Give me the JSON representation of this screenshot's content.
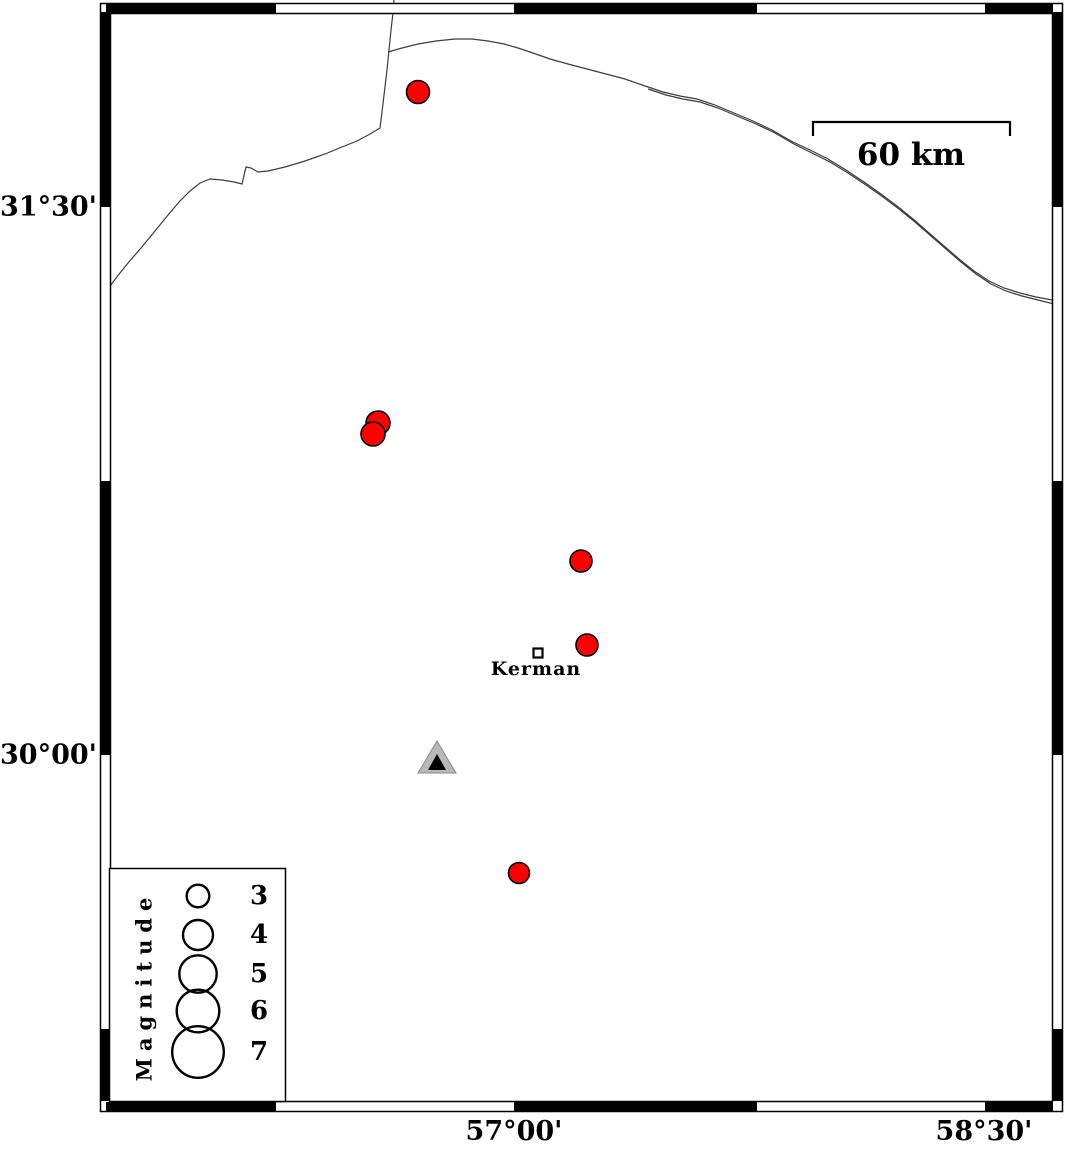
{
  "colors": {
    "epicenter_fill": "#ff0000",
    "epicenter_stroke": "#000000",
    "station_fill": "#b8b8b8",
    "station_edge": "#8a8a8a",
    "station_inner": "#000000",
    "fault_line": "#3d3d3d",
    "frame": "#000000",
    "background": "#ffffff"
  },
  "frame": {
    "outer": {
      "x": 100.5,
      "y": 3.5,
      "w": 962,
      "h": 1108
    },
    "inner": {
      "x": 110.5,
      "y": 13.5,
      "w": 942,
      "h": 1088
    },
    "band_h_black_segments": [
      [
        106,
        276
      ],
      [
        514,
        757
      ],
      [
        985,
        1053
      ]
    ],
    "band_v_black_segments": [
      [
        12,
        207
      ],
      [
        481,
        755
      ],
      [
        1029,
        1101
      ]
    ]
  },
  "axes": {
    "left": [
      {
        "label": "31°30'",
        "y": 207
      },
      {
        "label": "30°00'",
        "y": 755
      }
    ],
    "bottom": [
      {
        "label": "57°00'",
        "x": 514
      },
      {
        "label": "58°30'",
        "x": 984
      }
    ]
  },
  "scale_bar": {
    "label": "60 km",
    "x1": 813,
    "x2": 1010,
    "y": 122,
    "tick_len": 14,
    "label_cx": 911,
    "label_cy": 155
  },
  "city": {
    "name": "Kerman",
    "square": {
      "x": 533.5,
      "y": 648.5,
      "size": 9
    },
    "label_cx": 536,
    "label_cy": 669
  },
  "station": {
    "outer": {
      "apex_x": 437,
      "apex_y": 741,
      "base_y": 773,
      "half_w": 19
    },
    "inner": {
      "apex_x": 437,
      "apex_y": 754,
      "base_y": 770,
      "half_w": 9
    }
  },
  "earthquakes": [
    {
      "x": 418,
      "y": 92,
      "r": 11.5
    },
    {
      "x": 378,
      "y": 423,
      "r": 12
    },
    {
      "x": 373,
      "y": 434,
      "r": 12
    },
    {
      "x": 581,
      "y": 561,
      "r": 11
    },
    {
      "x": 587,
      "y": 645,
      "r": 11
    },
    {
      "x": 519,
      "y": 873,
      "r": 10.5
    }
  ],
  "legend": {
    "title": "Magnitude",
    "box": {
      "x": 109.5,
      "y": 868.5,
      "w": 176,
      "h": 233
    },
    "title_cx": 144,
    "title_cy": 986,
    "circle_cx": 198,
    "num_cx": 259,
    "entries": [
      {
        "magnitude": "3",
        "cy": 896,
        "r": 11.3
      },
      {
        "magnitude": "4",
        "cy": 935,
        "r": 15
      },
      {
        "magnitude": "5",
        "cy": 974,
        "r": 18.7
      },
      {
        "magnitude": "6",
        "cy": 1011,
        "r": 21.3
      },
      {
        "magnitude": "7",
        "cy": 1052,
        "r": 25.8
      }
    ]
  },
  "fault_lines": [
    {
      "name": "boundary-line-west",
      "d": "M394,0 L393,13 L391,30 L389,50 L387,70 L384,95 L382,112 L380,128 L370,134 L357,141 L342,147 L325,154 L305,161 L285,167 L268,171 L258,172 L251,168 L246,167 L242,184 L234,182 L222,180 L210,179 L200,183 L190,191 L180,201 L168,215 L155,231 L141,248 L128,263 L116,278 L108,289"
    },
    {
      "name": "northern-line-main",
      "d": "M388,52 L402,48 L418,44 L436,41 L455,39 L472,39 L488,41 L504,44 L518,48 L533,53 L550,59 L568,64 L587,69 L606,74 L625,79 L645,86 L663,92 L680,96 L697,99 L715,105 L734,113 L753,121 L772,130 L791,141 L810,150 L828,159 L846,170 L864,182 L881,194 L897,206 L913,219 L929,233 L944,246 L959,259 L974,271 L989,281 L1004,288 L1020,293 L1036,297 L1058,301"
    },
    {
      "name": "northern-line-second",
      "d": "M648,89 L666,95 L683,99 L700,102 L718,108 L737,116 L756,124 L775,133 L794,144 L812,153 L830,162 L848,173 L866,185 L883,197 L899,209 L915,222 L931,236 L946,249 L961,262 L976,274 L991,284 L1006,291 L1022,296 L1038,300 L1058,305"
    }
  ]
}
